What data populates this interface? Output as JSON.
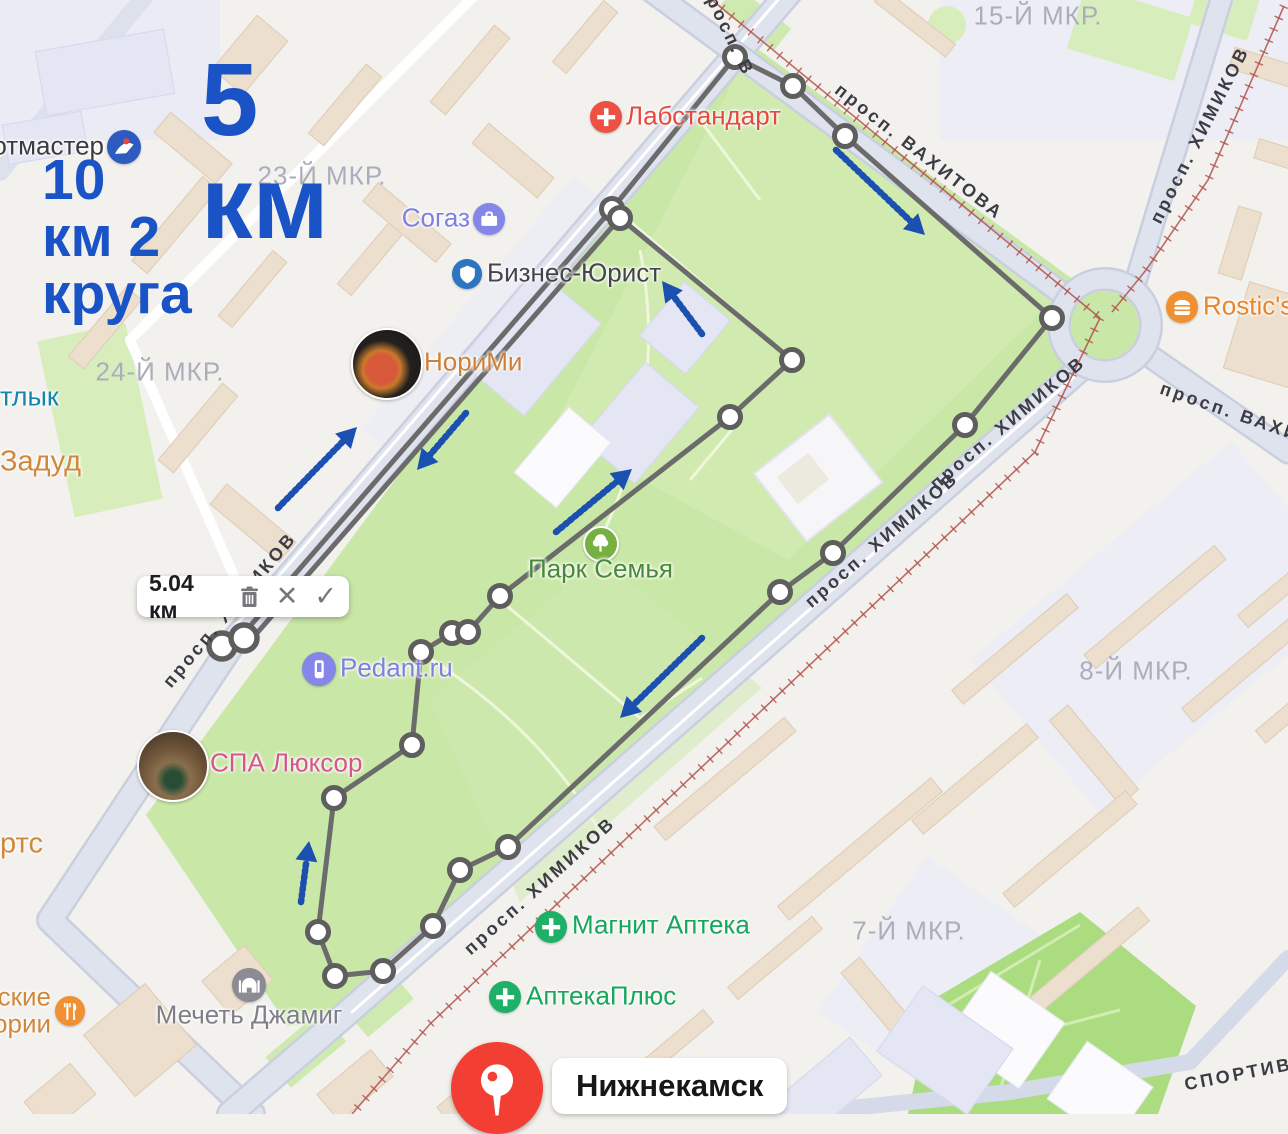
{
  "map": {
    "distance_overlay": {
      "line1": "5 км",
      "line2": "10 км 2 круга",
      "color": "#1a53c6"
    },
    "measure_box": {
      "value": "5.04 км",
      "icons": [
        "trash-icon",
        "close-icon",
        "check-icon"
      ]
    },
    "pin": {
      "label": "Нижнекамск",
      "color": "#f23e33"
    },
    "districts": [
      {
        "text": "15-Й МКР.",
        "x": 1038,
        "y": 16
      },
      {
        "text": "23-Й МКР.",
        "x": 322,
        "y": 176
      },
      {
        "text": "24-Й МКР.",
        "x": 160,
        "y": 372
      },
      {
        "text": "8-Й МКР.",
        "x": 1136,
        "y": 671
      },
      {
        "text": "7-Й МКР.",
        "x": 909,
        "y": 931
      }
    ],
    "streets": [
      {
        "text": "просп. ВАХИТОВА",
        "x": 919,
        "y": 152,
        "rot": 38
      },
      {
        "text": "просп. ХИМИКОВ",
        "x": 1200,
        "y": 135,
        "rot": -63
      },
      {
        "text": "просп. ВАХИ",
        "x": 1230,
        "y": 412,
        "rot": 19
      },
      {
        "text": "просп. ХИМИКОВ",
        "x": 1008,
        "y": 423,
        "rot": -40
      },
      {
        "text": "просп. ХИМИКОВ",
        "x": 882,
        "y": 540,
        "rot": -41
      },
      {
        "text": "просп. ХИМИКОВ",
        "x": 540,
        "y": 886,
        "rot": -42
      },
      {
        "text": "просп. ХИМИКОВ",
        "x": 230,
        "y": 610,
        "rot": -50
      },
      {
        "text": "просп. В",
        "x": 727,
        "y": 30,
        "rot": 64
      },
      {
        "text": "СПОРТИВНАЯ",
        "x": 1262,
        "y": 1070,
        "rot": -11
      }
    ],
    "pois": [
      {
        "id": "sportmaster",
        "label": "отмастер",
        "color": "#3a3a40",
        "icon": "sportmaster-icon",
        "icon_bg": "#2d5bc0",
        "ix": 124,
        "iy": 147,
        "r": 17,
        "tx": 104,
        "ty": 146,
        "align": "right"
      },
      {
        "id": "labstandart",
        "label": "Лабстандарт",
        "color": "#e64a3e",
        "icon": "medical-cross-icon",
        "icon_bg": "#ef5044",
        "ix": 606,
        "iy": 117,
        "r": 16,
        "tx": 626,
        "ty": 116,
        "align": "left"
      },
      {
        "id": "sogaz",
        "label": "Согаз",
        "color": "#7e7fe1",
        "icon": "briefcase-icon",
        "icon_bg": "#8486e8",
        "ix": 489,
        "iy": 219,
        "r": 16,
        "tx": 470,
        "ty": 218,
        "align": "right"
      },
      {
        "id": "biznes-yurist",
        "label": "Бизнес-Юрист",
        "color": "#44444c",
        "icon": "shield-icon",
        "icon_bg": "#2d74c2",
        "ix": 467,
        "iy": 274,
        "r": 15,
        "tx": 487,
        "ty": 273,
        "align": "left"
      },
      {
        "id": "norimi",
        "label": "НориМи",
        "color": "#cd8038",
        "icon": "photo-norimi",
        "icon_bg": "",
        "ix": 385,
        "iy": 362,
        "r": 34,
        "tx": 424,
        "ty": 362,
        "align": "left"
      },
      {
        "id": "park-semya",
        "label": "Парк Семья",
        "color": "#49893a",
        "icon": "tree-icon",
        "icon_bg": "#76b043",
        "ix": 599,
        "iy": 542,
        "r": 16,
        "tx": 528,
        "ty": 569,
        "align": "left"
      },
      {
        "id": "pedant",
        "label": "Pedant.ru",
        "color": "#7e7fe1",
        "icon": "phone-icon",
        "icon_bg": "#8486e8",
        "ix": 319,
        "iy": 669,
        "r": 17,
        "tx": 340,
        "ty": 668,
        "align": "left"
      },
      {
        "id": "spa-luxor",
        "label": "СПА Люксор",
        "color": "#d6558c",
        "icon": "photo-spa",
        "icon_bg": "",
        "ix": 171,
        "iy": 764,
        "r": 34,
        "tx": 210,
        "ty": 763,
        "align": "left"
      },
      {
        "id": "magnit-apteka",
        "label": "Магнит Аптека",
        "color": "#16a75c",
        "icon": "pharmacy-cross-icon",
        "icon_bg": "#1db066",
        "ix": 551,
        "iy": 927,
        "r": 16,
        "tx": 572,
        "ty": 925,
        "align": "left"
      },
      {
        "id": "apteka-plus",
        "label": "АптекаПлюс",
        "color": "#16a75c",
        "icon": "pharmacy-cross-icon",
        "icon_bg": "#1db066",
        "ix": 505,
        "iy": 997,
        "r": 16,
        "tx": 526,
        "ty": 996,
        "align": "left"
      },
      {
        "id": "mechet-dzhamig",
        "label": "Мечеть Джамиг",
        "color": "#7f7f89",
        "icon": "mosque-icon",
        "icon_bg": "#8b8b95",
        "ix": 249,
        "iy": 985,
        "r": 17,
        "tx": 249,
        "ty": 1015,
        "align": "center"
      },
      {
        "id": "rostics",
        "label": "Rostic's",
        "color": "#e9862c",
        "icon": "burger-icon",
        "icon_bg": "#f09032",
        "ix": 1182,
        "iy": 307,
        "r": 16,
        "tx": 1203,
        "ty": 306,
        "align": "left"
      }
    ],
    "small_labels": [
      {
        "id": "tlyk",
        "text": "тлык",
        "color": "#1386ad",
        "x": 0,
        "y": 397,
        "size": 27
      },
      {
        "id": "zadud",
        "text": "Задуд",
        "color": "#d0883c",
        "x": 0,
        "y": 462,
        "size": 29
      },
      {
        "id": "rts",
        "text": "ртс",
        "color": "#d0883c",
        "x": 0,
        "y": 844,
        "size": 29
      }
    ],
    "stories_label": {
      "line1": "ские",
      "line2": "ории",
      "color": "#d0883c",
      "icon": "cutlery-icon",
      "icon_bg": "#f09032",
      "ix": 70,
      "iy": 1011,
      "r": 15
    }
  },
  "route": {
    "color": "#6b6b6b",
    "arrow_color": "#1b4fb0",
    "out_segment": {
      "from": [
        237,
        641
      ],
      "to": [
        612,
        209
      ]
    },
    "back_segment": {
      "from": [
        620,
        218
      ],
      "to": [
        243,
        649
      ]
    },
    "loop_points": [
      [
        612,
        209
      ],
      [
        735,
        57
      ],
      [
        793,
        86
      ],
      [
        845,
        136
      ],
      [
        1052,
        318
      ],
      [
        965,
        425
      ],
      [
        833,
        553
      ],
      [
        780,
        592
      ],
      [
        508,
        847
      ],
      [
        460,
        870
      ],
      [
        433,
        926
      ],
      [
        383,
        971
      ],
      [
        335,
        976
      ],
      [
        318,
        932
      ],
      [
        334,
        798
      ],
      [
        412,
        745
      ],
      [
        421,
        652
      ],
      [
        452,
        633
      ],
      [
        468,
        632
      ],
      [
        500,
        596
      ],
      [
        730,
        417
      ],
      [
        792,
        360
      ],
      [
        620,
        218
      ]
    ],
    "start_vertices": [
      [
        222,
        646
      ],
      [
        244,
        638
      ]
    ],
    "arrows": [
      {
        "tail": [
          278,
          508
        ],
        "head": [
          357,
          427
        ]
      },
      {
        "tail": [
          466,
          413
        ],
        "head": [
          417,
          470
        ]
      },
      {
        "tail": [
          836,
          150
        ],
        "head": [
          925,
          235
        ]
      },
      {
        "tail": [
          556,
          532
        ],
        "head": [
          632,
          469
        ]
      },
      {
        "tail": [
          702,
          334
        ],
        "head": [
          662,
          281
        ]
      },
      {
        "tail": [
          702,
          638
        ],
        "head": [
          620,
          718
        ]
      },
      {
        "tail": [
          301,
          902
        ],
        "head": [
          309,
          841
        ]
      }
    ]
  }
}
